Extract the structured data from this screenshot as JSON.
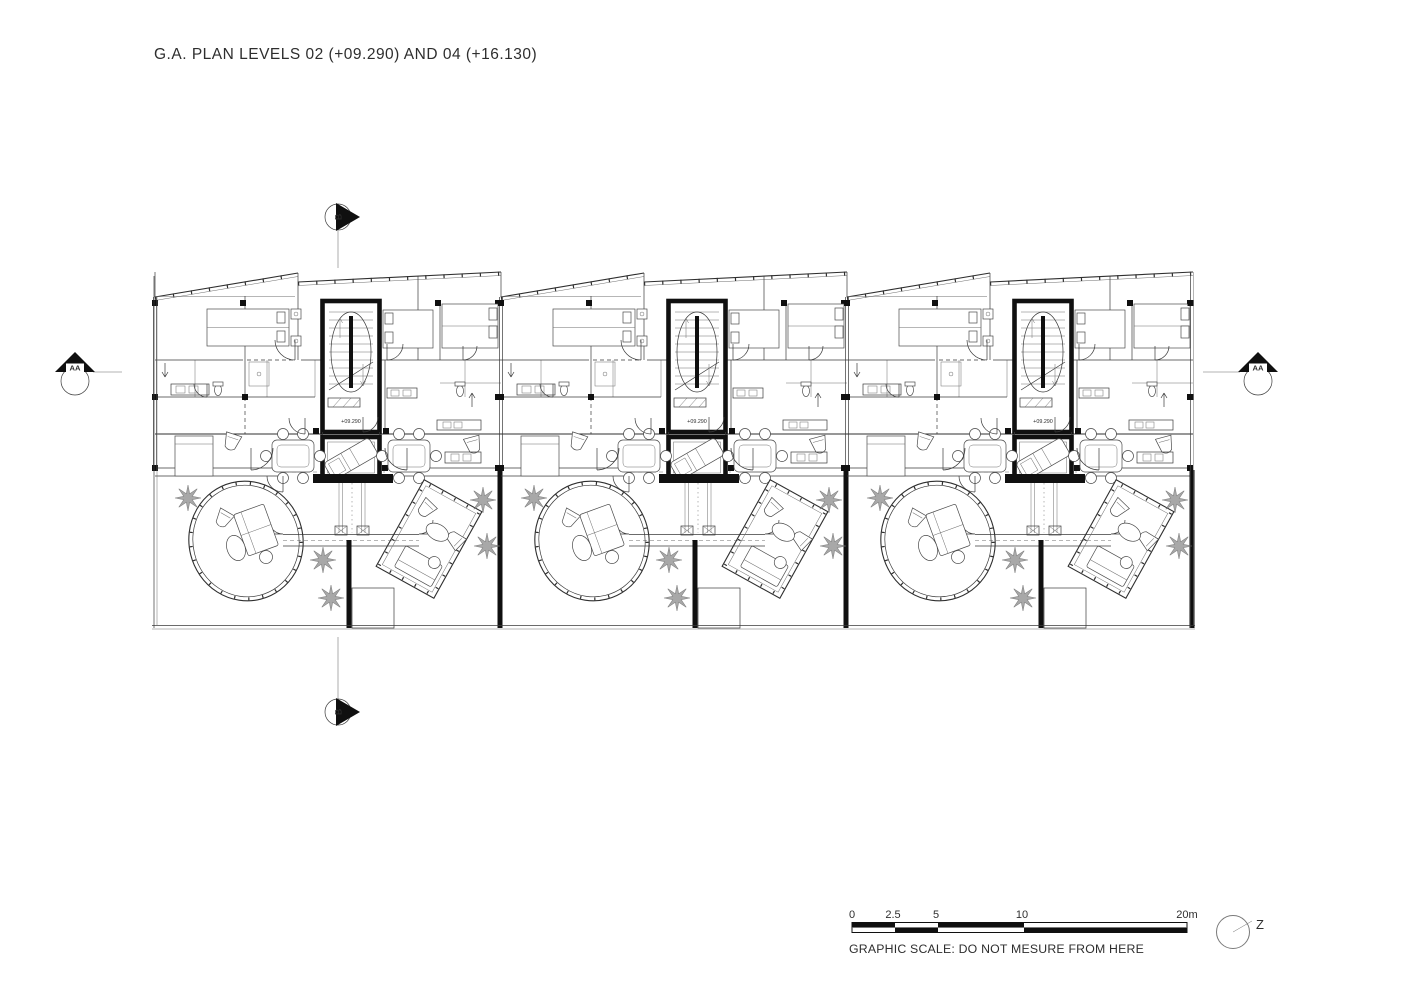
{
  "title": "G.A. PLAN LEVELS 02 (+09.290) AND 04 (+16.130)",
  "plan": {
    "level_label": "+09.290",
    "unit_count": 3
  },
  "markers": {
    "section_b_top": "B",
    "section_b_bottom": "B",
    "section_aa_left": "AA",
    "section_aa_right": "AA",
    "north_label": "Z"
  },
  "scale_bar": {
    "ticks": [
      "0",
      "2.5",
      "5",
      "10",
      "20m"
    ],
    "caption": "GRAPHIC SCALE: DO NOT MESURE FROM HERE"
  },
  "colors": {
    "ink": "#2e2e2e",
    "bold_wall": "#101010",
    "tree": "#9a9a9a",
    "paper": "#ffffff"
  }
}
